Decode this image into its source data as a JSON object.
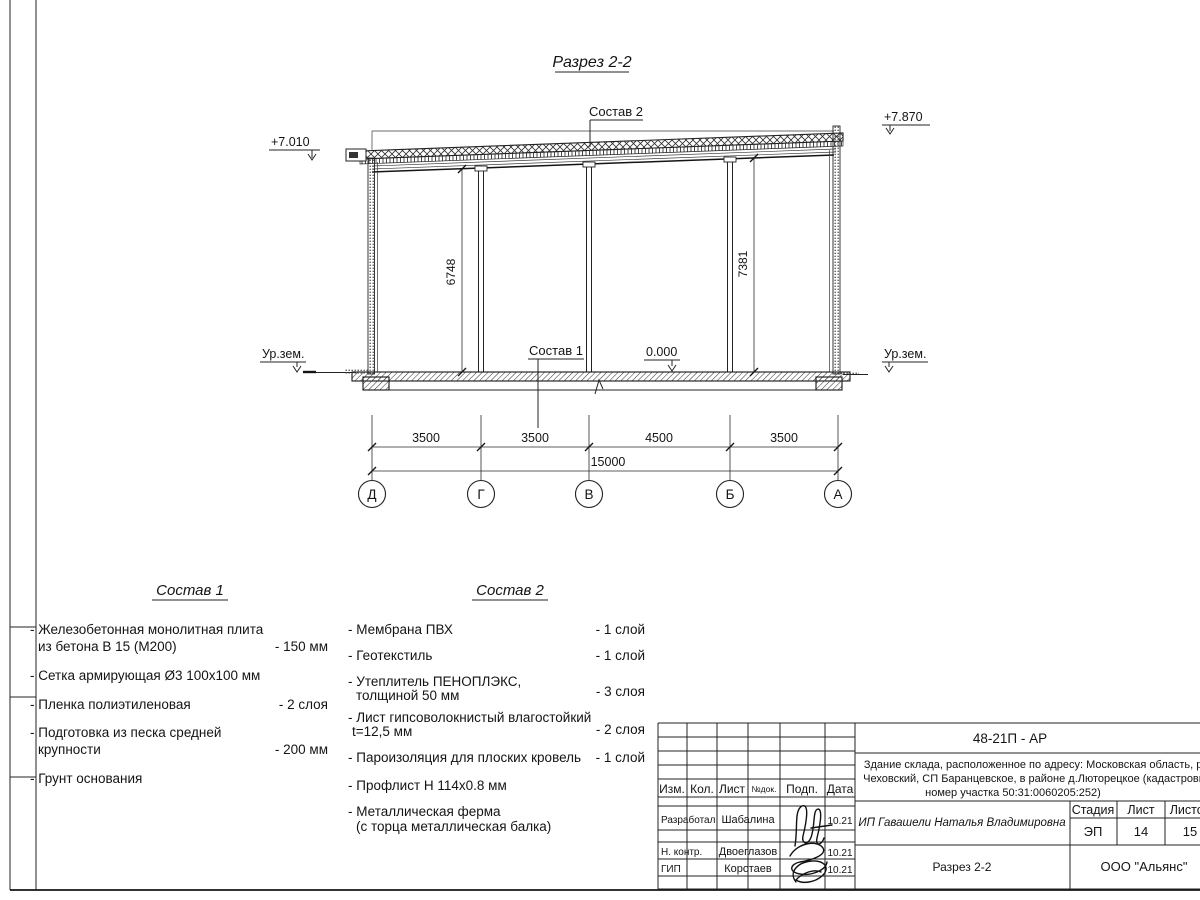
{
  "drawing": {
    "title": "Разрез 2-2",
    "callout_top": "Состав 2",
    "callout_floor": "Состав 1",
    "elev_left": "+7.010",
    "elev_right": "+7.870",
    "elev_zero": "0.000",
    "ground_left": "Ур.зем.",
    "ground_right": "Ур.зем.",
    "dim_left_height": "6748",
    "dim_right_height": "7381",
    "axes": [
      "Д",
      "Г",
      "В",
      "Б",
      "А"
    ],
    "span_dims": [
      "3500",
      "3500",
      "4500",
      "3500"
    ],
    "total_dim": "15000"
  },
  "comp1": {
    "title": "Состав 1",
    "items": [
      {
        "l1": "- Железобетонная  монолитная плита",
        "l2": "из бетона В 15 (М200)",
        "val": "- 150 мм"
      },
      {
        "l1": "- Сетка армирующая Ø3 100х100 мм",
        "l2": "",
        "val": ""
      },
      {
        "l1": "- Пленка полиэтиленовая",
        "l2": "",
        "val": "-  2 слоя"
      },
      {
        "l1": "- Подготовка из песка средней",
        "l2": "крупности",
        "val": "- 200 мм"
      },
      {
        "l1": "- Грунт основания",
        "l2": "",
        "val": ""
      }
    ]
  },
  "comp2": {
    "title": "Состав 2",
    "items": [
      {
        "l1": "- Мембрана ПВХ",
        "l2": "",
        "val": "- 1 слой"
      },
      {
        "l1": "- Геотекстиль",
        "l2": "",
        "val": "- 1 слой"
      },
      {
        "l1": "- Утеплитель ПЕНОПЛЭКС,",
        "l2": "толщиной 50 мм",
        "val": "- 3 слоя"
      },
      {
        "l1": "- Лист гипсоволокнистый влагостойкий",
        "l2": "t=12,5 мм",
        "val": "- 2 слоя"
      },
      {
        "l1": "- Пароизоляция для плоских кровель",
        "l2": "",
        "val": "- 1 слой"
      },
      {
        "l1": "- Профлист Н 114х0.8 мм",
        "l2": "",
        "val": ""
      },
      {
        "l1": "- Металлическая ферма",
        "l2": "(с торца металлическая балка)",
        "val": ""
      }
    ]
  },
  "titleblock": {
    "code": "48-21П - АР",
    "desc1": "Здание склада, расположенное по адресу: Московская область, р-н",
    "desc2": "Чеховский, СП Баранцевское, в районе д.Люторецкое  (кадастровый",
    "desc3": "номер участка 50:31:0060205:252)",
    "col_izm": "Изм.",
    "col_kol": "Кол.",
    "col_list": "Лист",
    "col_ndok": "№док.",
    "col_podp": "Подп.",
    "col_data": "Дата",
    "rows": [
      {
        "role": "Разработал",
        "name": "Шабалина",
        "date": "10.21"
      },
      {
        "role": "Н. контр.",
        "name": "Двоеглазов",
        "date": "10.21"
      },
      {
        "role": "ГИП",
        "name": "Коротаев",
        "date": "10.21"
      }
    ],
    "client": "ИП Гавашели Наталья Владимировна",
    "stage_label": "Стадия",
    "sheet_label": "Лист",
    "sheets_label": "Листов",
    "stage": "ЭП",
    "sheet": "14",
    "sheets": "15",
    "doc_name": "Разрез 2-2",
    "company": "ООО \"Альянс\""
  }
}
